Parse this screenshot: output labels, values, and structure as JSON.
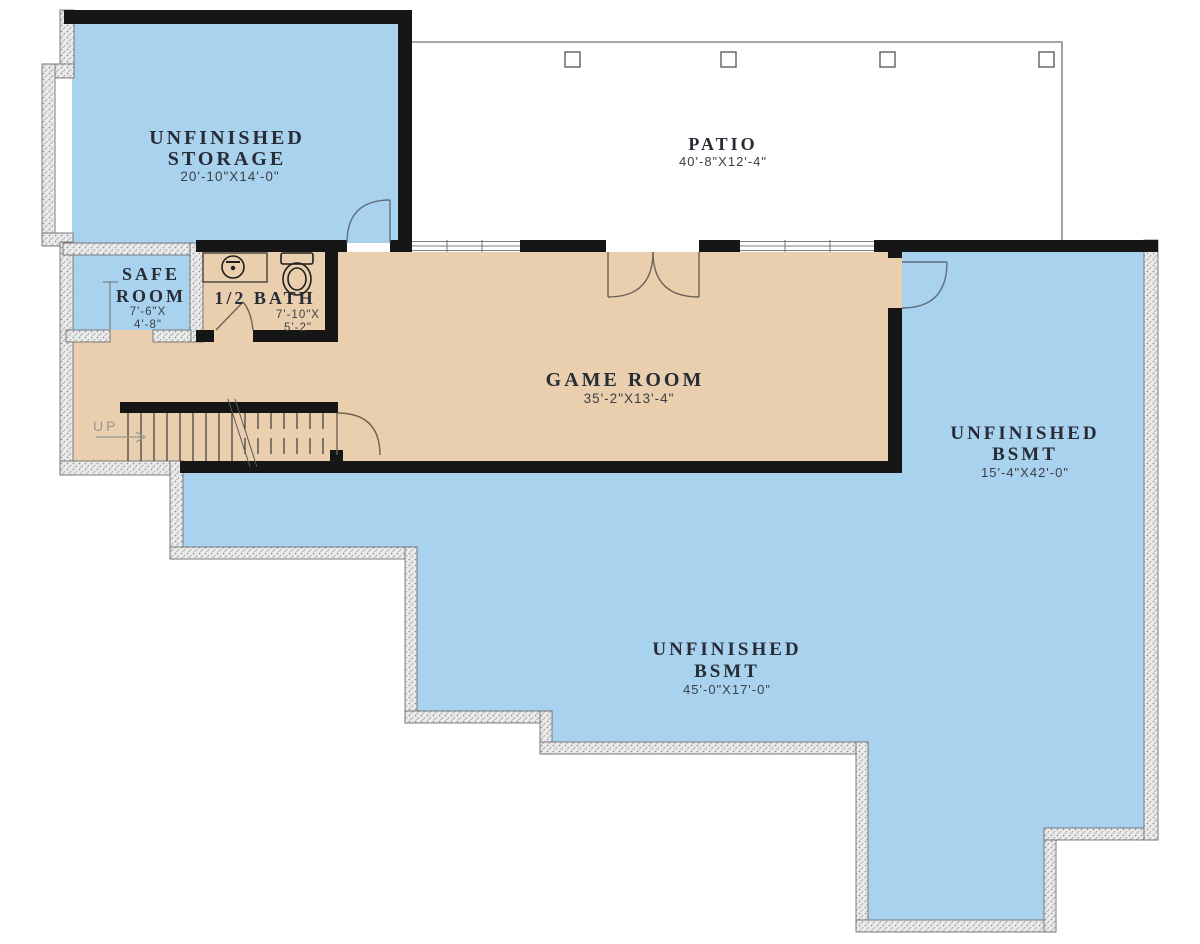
{
  "plan": {
    "rooms": {
      "storage": {
        "name_line1": "UNFINISHED",
        "name_line2": "STORAGE",
        "dims": "20'-10\"X14'-0\""
      },
      "patio": {
        "name": "PATIO",
        "dims": "40'-8\"X12'-4\""
      },
      "safe_room": {
        "name_line1": "SAFE",
        "name_line2": "ROOM",
        "dims_line1": "7'-6\"X",
        "dims_line2": "4'-8\""
      },
      "half_bath": {
        "name": "1/2 BATH",
        "dims_line1": "7'-10\"X",
        "dims_line2": "5'-2\""
      },
      "game_room": {
        "name": "GAME ROOM",
        "dims": "35'-2\"X13'-4\""
      },
      "bsmt_right": {
        "name_line1": "UNFINISHED",
        "name_line2": "BSMT",
        "dims": "15'-4\"X42'-0\""
      },
      "bsmt_lower": {
        "name_line1": "UNFINISHED",
        "name_line2": "BSMT",
        "dims": "45'-0\"X17'-0\""
      }
    },
    "stairs": {
      "label": "UP"
    },
    "colors": {
      "finished_floor": "#eacfae",
      "unfinished_floor": "#a9d2ef",
      "wall": "#161616",
      "patio_outline": "#8c8c8c",
      "label_text": "#272c35",
      "dim_text": "#3c4046"
    }
  }
}
